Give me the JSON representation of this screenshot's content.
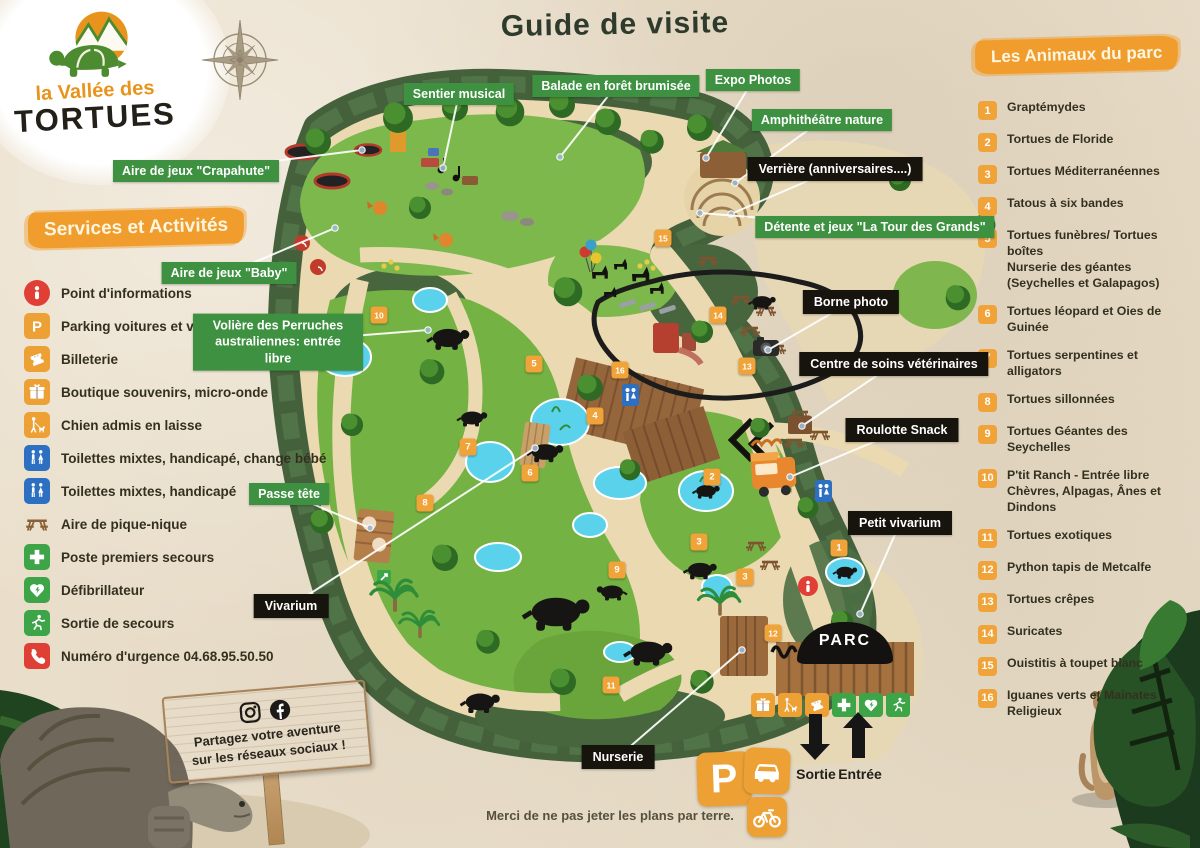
{
  "logo": {
    "line1": "la Vallée des",
    "line2": "TORTUES"
  },
  "title": "Guide de visite",
  "services": {
    "header": "Services et Activités",
    "items": [
      {
        "icon": "info",
        "color": "#df3f35",
        "round": true,
        "label": "Point d'informations"
      },
      {
        "icon": "parking",
        "color": "#eda135",
        "label": "Parking voitures et vélos"
      },
      {
        "icon": "ticket",
        "color": "#eda135",
        "label": "Billeterie"
      },
      {
        "icon": "gift",
        "color": "#eda135",
        "label": "Boutique souvenirs, micro-onde"
      },
      {
        "icon": "dog",
        "color": "#eda135",
        "label": "Chien admis en laisse"
      },
      {
        "icon": "wc",
        "color": "#2d6fc0",
        "label": "Toilettes mixtes, handicapé, change bébé"
      },
      {
        "icon": "wc",
        "color": "#2d6fc0",
        "label": "Toilettes mixtes, handicapé"
      },
      {
        "icon": "picnic",
        "color": "transparent",
        "bare": true,
        "label": "Aire de pique-nique"
      },
      {
        "icon": "cross",
        "color": "#3da448",
        "label": "Poste premiers secours"
      },
      {
        "icon": "defib",
        "color": "#3da448",
        "label": "Défibrillateur"
      },
      {
        "icon": "runner",
        "color": "#3da448",
        "label": "Sortie de secours"
      },
      {
        "icon": "phone",
        "color": "#df3f35",
        "label": "Numéro d'urgence 04.68.95.50.50"
      }
    ]
  },
  "animals": {
    "header": "Les Animaux du parc",
    "items": [
      {
        "num": "1",
        "label": "Graptémydes"
      },
      {
        "num": "2",
        "label": "Tortues de Floride"
      },
      {
        "num": "3",
        "label": "Tortues Méditerranéennes"
      },
      {
        "num": "4",
        "label": "Tatous à six bandes"
      },
      {
        "num": "5",
        "label": "Tortues funèbres/ Tortues boîtes\nNurserie des géantes (Seychelles et Galapagos)"
      },
      {
        "num": "6",
        "label": "Tortues léopard et Oies de Guinée"
      },
      {
        "num": "7",
        "label": "Tortues serpentines et alligators"
      },
      {
        "num": "8",
        "label": "Tortues sillonnées"
      },
      {
        "num": "9",
        "label": "Tortues Géantes des Seychelles"
      },
      {
        "num": "10",
        "label": "P'tit Ranch - Entrée libre\nChèvres, Alpagas, Ânes et Dindons"
      },
      {
        "num": "11",
        "label": "Tortues exotiques"
      },
      {
        "num": "12",
        "label": "Python tapis de Metcalfe"
      },
      {
        "num": "13",
        "label": "Tortues crêpes"
      },
      {
        "num": "14",
        "label": "Suricates"
      },
      {
        "num": "15",
        "label": "Ouistitis à toupet blanc"
      },
      {
        "num": "16",
        "label": "Iguanes verts et  Mainates Religieux"
      }
    ]
  },
  "map": {
    "labels": [
      {
        "text": "Sentier musical",
        "type": "green",
        "x": 459,
        "y": 94,
        "tx": 443,
        "ty": 168
      },
      {
        "text": "Balade en forêt brumisée",
        "type": "green",
        "x": 616,
        "y": 86,
        "tx": 560,
        "ty": 157
      },
      {
        "text": "Expo Photos",
        "type": "green",
        "x": 753,
        "y": 80,
        "tx": 706,
        "ty": 158
      },
      {
        "text": "Amphithéâtre nature",
        "type": "green",
        "x": 822,
        "y": 120,
        "tx": 735,
        "ty": 183
      },
      {
        "text": "Verrière (anniversaires....)",
        "type": "black",
        "x": 835,
        "y": 169,
        "tx": 731,
        "ty": 214
      },
      {
        "text": "Détente et jeux \"La Tour des Grands\"",
        "type": "green",
        "x": 875,
        "y": 227,
        "tx": 700,
        "ty": 213
      },
      {
        "text": "Aire de jeux \"Crapahute\"",
        "type": "green",
        "x": 196,
        "y": 171,
        "tx": 362,
        "ty": 150
      },
      {
        "text": "Aire de jeux \"Baby\"",
        "type": "green",
        "x": 229,
        "y": 273,
        "tx": 335,
        "ty": 228
      },
      {
        "text": "Volière des Perruches australiennes: entrée libre",
        "type": "green",
        "wrap": true,
        "x": 278,
        "y": 342,
        "tx": 428,
        "ty": 330
      },
      {
        "text": "Borne photo",
        "type": "black",
        "x": 851,
        "y": 302,
        "tx": 768,
        "ty": 350
      },
      {
        "text": "Centre de soins vétérinaires",
        "type": "black",
        "x": 894,
        "y": 364,
        "tx": 802,
        "ty": 426
      },
      {
        "text": "Roulotte Snack",
        "type": "black",
        "x": 902,
        "y": 430,
        "tx": 790,
        "ty": 477
      },
      {
        "text": "Petit vivarium",
        "type": "black",
        "x": 900,
        "y": 523,
        "tx": 860,
        "ty": 614
      },
      {
        "text": "Passe tête",
        "type": "green",
        "x": 289,
        "y": 494,
        "tx": 370,
        "ty": 528
      },
      {
        "text": "Vivarium",
        "type": "black",
        "x": 291,
        "y": 606,
        "tx": 535,
        "ty": 448
      },
      {
        "text": "Nurserie",
        "type": "black",
        "x": 618,
        "y": 757,
        "tx": 742,
        "ty": 650
      }
    ],
    "markers": [
      {
        "n": "1",
        "x": 839,
        "y": 548
      },
      {
        "n": "2",
        "x": 712,
        "y": 477
      },
      {
        "n": "3",
        "x": 699,
        "y": 542
      },
      {
        "n": "3",
        "x": 745,
        "y": 577
      },
      {
        "n": "4",
        "x": 595,
        "y": 416
      },
      {
        "n": "5",
        "x": 534,
        "y": 364
      },
      {
        "n": "6",
        "x": 530,
        "y": 473
      },
      {
        "n": "7",
        "x": 468,
        "y": 447
      },
      {
        "n": "8",
        "x": 425,
        "y": 503
      },
      {
        "n": "9",
        "x": 617,
        "y": 570
      },
      {
        "n": "10",
        "x": 379,
        "y": 315
      },
      {
        "n": "11",
        "x": 611,
        "y": 685
      },
      {
        "n": "12",
        "x": 773,
        "y": 633
      },
      {
        "n": "13",
        "x": 747,
        "y": 366
      },
      {
        "n": "14",
        "x": 718,
        "y": 315
      },
      {
        "n": "15",
        "x": 663,
        "y": 238
      },
      {
        "n": "16",
        "x": 620,
        "y": 370
      }
    ],
    "entrance": {
      "parc": "PARC",
      "sortie": "Sortie",
      "entree": "Entrée",
      "parking_p": "P"
    },
    "entrance_icons": [
      {
        "icon": "gift",
        "color": "#eda135"
      },
      {
        "icon": "dog",
        "color": "#eda135"
      },
      {
        "icon": "ticket",
        "color": "#eda135"
      },
      {
        "icon": "cross",
        "color": "#3da448"
      },
      {
        "icon": "defib",
        "color": "#3da448"
      },
      {
        "icon": "runner",
        "color": "#3da448"
      }
    ]
  },
  "social": {
    "line1": "Partagez votre aventure",
    "line2": "sur les réseaux sociaux !"
  },
  "footer": "Merci de ne pas jeter les plans par terre.",
  "colors": {
    "accent_orange": "#f09d2e",
    "label_green": "#3d9140",
    "label_black": "#17130d",
    "pond": "#5ad2ec"
  }
}
